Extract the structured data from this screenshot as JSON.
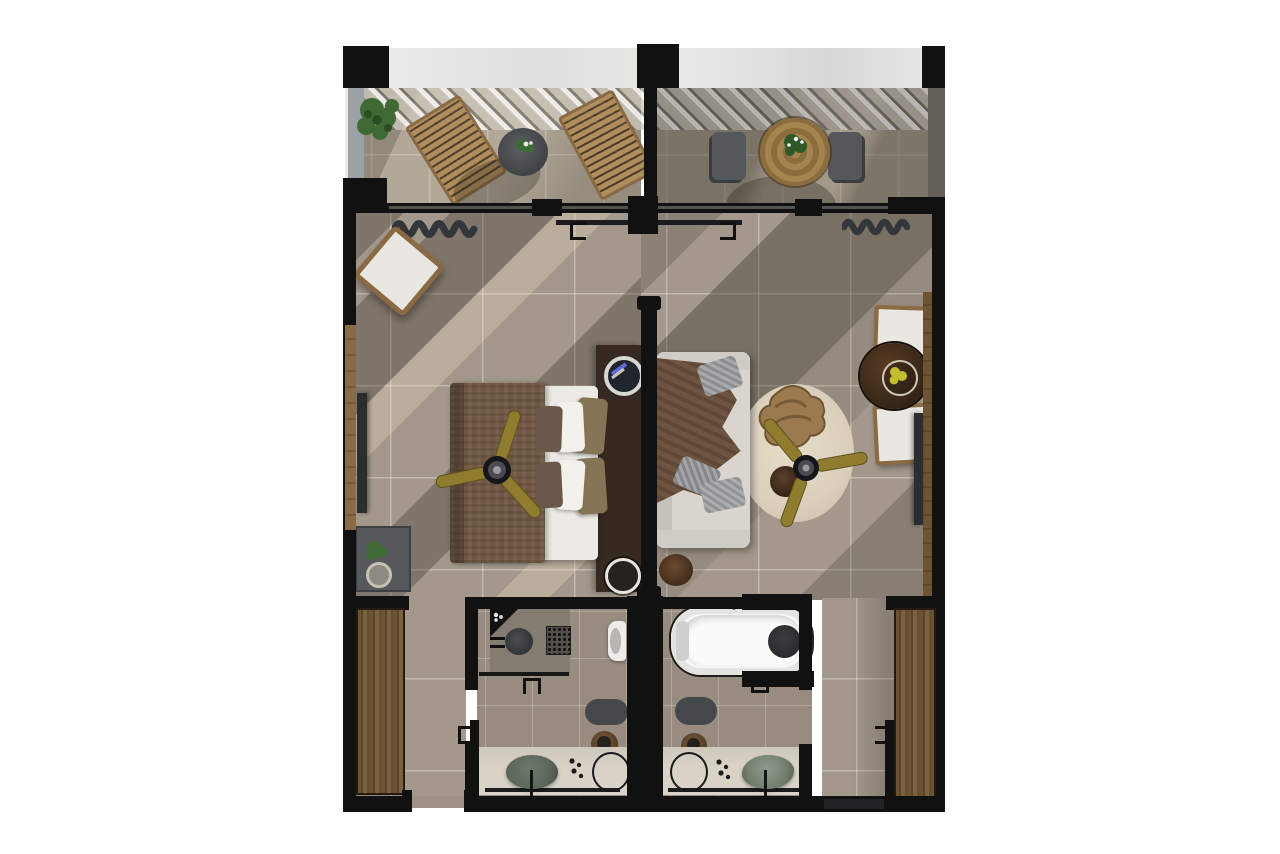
{
  "meta": {
    "description": "Top-down 3D rendered floor plan of two mirrored hotel suites: shared terrace strip on top with pergola, bedroom unit on the left, living-room unit on the right connected by an opening, en-suite bathrooms and wardrobe corridors at the bottom.",
    "visible_text": "none"
  },
  "palette": {
    "wall": "#111111",
    "floorMain": "#a3988b",
    "floorBath": "#978c7f",
    "balconyFloor": "#bdb2a1",
    "marble": "#e8e8e6",
    "balustrade": "#9ba1a4",
    "wood": "#b08d5a",
    "chairWood": "#8a6a43",
    "chairSeat": "#e9e7e2",
    "wardrobe": "#6d5334",
    "headboard": "#362a20",
    "blanket": "#705844",
    "mattress": "#eceae5",
    "pillowBrown": "#6a594a",
    "pillowWhite": "#f3f1ec",
    "pillowTaupe": "#857456",
    "sofa": "#d9d5ce",
    "throw": "#6e5542",
    "rug": "#d9cfbb",
    "fanGold": "#8f7c2e",
    "tableWalnut": "#3c2a1a",
    "tv": "#2b2d2f",
    "minibar": "#56595b",
    "plantGreen": "#3f6a33",
    "curtain": "#33363a",
    "showerFloor": "#857c71",
    "drain": "#3f4245",
    "toilet": "#edecea",
    "mat": "#45484a",
    "stoolWood": "#6b4f33",
    "vanity": "#d9d3c7",
    "sink": "#5c675c",
    "tub": "#f7f7f5",
    "shadow": "rgba(58,50,42,0.34)",
    "sun": "rgba(238,222,196,0.30)"
  },
  "scene": {
    "areas": [
      "terrace-left",
      "terrace-right",
      "bedroom",
      "living-room",
      "bathroom-left",
      "bathroom-right",
      "corridor-left",
      "corridor-right"
    ],
    "terrace_left_items": [
      "corner-plant",
      "lounger-1",
      "lounger-2",
      "side-table-with-plant",
      "glass-balustrade",
      "pergola-slats"
    ],
    "terrace_right_items": [
      "round-dining-table-with-plant",
      "terrace-chair-1",
      "terrace-chair-2",
      "pergola-slats"
    ],
    "bedroom_items": [
      "curtain",
      "accent-armchair",
      "wall-tv",
      "minibar-cabinet-with-plant",
      "double-bed",
      "brown-blanket",
      "pillows",
      "ceiling-fan",
      "headboard-wall",
      "nightstand-top-decor",
      "nightstand-bottom-cup"
    ],
    "living_room_items": [
      "curtain",
      "sofa-with-throw-and-pillows",
      "round-rug",
      "hide-shaped-coffee-table",
      "dark-side-table",
      "ceiling-fan",
      "round-stool",
      "dining-table-with-fruit-bowl",
      "dining-chair-1",
      "dining-chair-2",
      "wall-tv",
      "wood-panel"
    ],
    "bathroom_left_items": [
      "walk-in-shower",
      "corner-shelf",
      "floor-drain",
      "rain-head-grate",
      "glass-screen-with-handle",
      "toilet",
      "bath-mat",
      "wood-stool",
      "vanity-counter",
      "vessel-sink",
      "round-mirror",
      "toiletries",
      "door-leaf"
    ],
    "bathroom_right_items": [
      "freestanding-bathtub",
      "headrest-pillow",
      "tub-tray",
      "glass-screen-with-handle",
      "bath-mat",
      "wood-stool",
      "vanity-counter",
      "vessel-sink",
      "round-mirror",
      "toiletries",
      "door-leaf"
    ],
    "corridor_items": [
      "full-height-wardrobe",
      "entry-door-opening"
    ],
    "connection": "open-passage-between-units-near-window"
  }
}
